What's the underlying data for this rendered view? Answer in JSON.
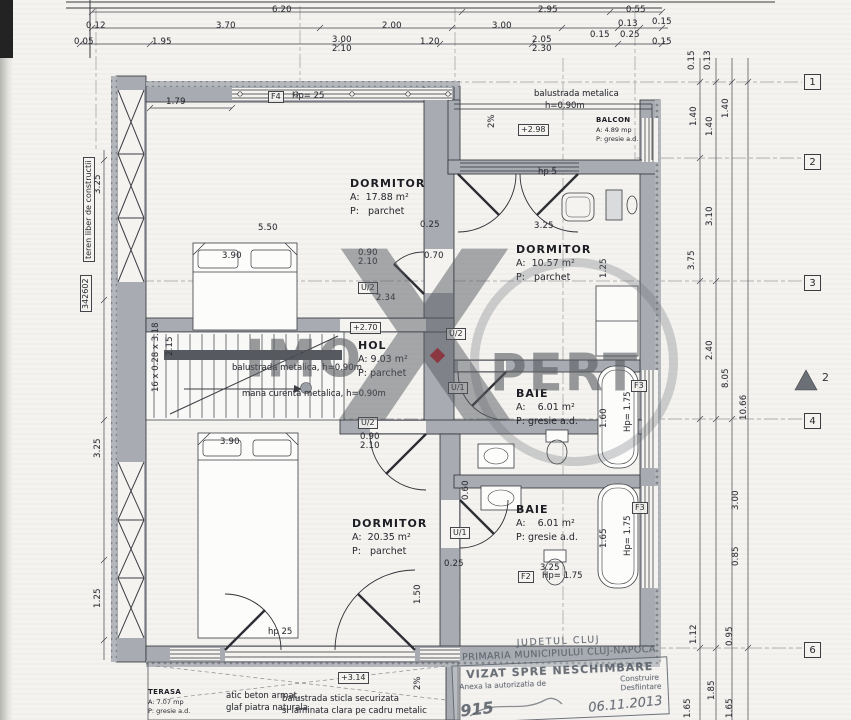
{
  "watermark": {
    "left": "IMO",
    "x_letter": "X",
    "right": "PERT"
  },
  "section_marker": {
    "label": "2"
  },
  "stamp": {
    "line1": "JUDETUL CLUJ",
    "line2": "PRIMARIA MUNICIPIULUI CLUJ-NAPOCA",
    "box_title": "VIZAT SPRE NESCHIMBARE",
    "box_sub": "Anexa la autorizatia de",
    "box_opt1": "Construire",
    "box_opt2": "Desfiintare",
    "hand1": "915",
    "hand2": "06.11.2013"
  },
  "rooms": [
    {
      "name": "DORMITOR",
      "area": "A:  17.88 m²",
      "floor": "P:   parchet",
      "x": 350,
      "y": 176
    },
    {
      "name": "DORMITOR",
      "area": "A:  10.57 m²",
      "floor": "P:   parchet",
      "x": 516,
      "y": 242
    },
    {
      "name": "HOL",
      "area": "A: 9.03 m²",
      "floor": "P: parchet",
      "x": 358,
      "y": 338
    },
    {
      "name": "BAIE",
      "area": "A:    6.01 m²",
      "floor": "P: gresie a.d.",
      "x": 516,
      "y": 386
    },
    {
      "name": "DORMITOR",
      "area": "A:  20.35 m²",
      "floor": "P:   parchet",
      "x": 352,
      "y": 516
    },
    {
      "name": "BAIE",
      "area": "A:    6.01 m²",
      "floor": "P: gresie a.d.",
      "x": 516,
      "y": 502
    },
    {
      "name": "BALCON",
      "area": "A: 4.89 mp",
      "floor": "P: gresie a.d.",
      "x": 596,
      "y": 116,
      "cls": "small"
    },
    {
      "name": "TERASA",
      "area": "A: 7.07 mp",
      "floor": "P: gresie a.d.",
      "x": 148,
      "y": 688,
      "cls": "small"
    }
  ],
  "dims": [
    {
      "t": "6.20",
      "x": 272,
      "y": 6
    },
    {
      "t": "2.95",
      "x": 538,
      "y": 6
    },
    {
      "t": "0.55",
      "x": 626,
      "y": 6
    },
    {
      "t": "0.12",
      "x": 86,
      "y": 22
    },
    {
      "t": "3.70",
      "x": 216,
      "y": 22
    },
    {
      "t": "2.00",
      "x": 382,
      "y": 22
    },
    {
      "t": "3.00",
      "x": 492,
      "y": 22
    },
    {
      "t": "0.13",
      "x": 618,
      "y": 20
    },
    {
      "t": "0.15",
      "x": 652,
      "y": 18
    },
    {
      "t": "0.15",
      "x": 590,
      "y": 31
    },
    {
      "t": "0.25",
      "x": 620,
      "y": 31
    },
    {
      "t": "0.05",
      "x": 74,
      "y": 38
    },
    {
      "t": "1.95",
      "x": 152,
      "y": 38
    },
    {
      "t": "3.00",
      "x": 332,
      "y": 36
    },
    {
      "t": "2.10",
      "x": 332,
      "y": 45
    },
    {
      "t": "1.20",
      "x": 420,
      "y": 38
    },
    {
      "t": "2.05",
      "x": 532,
      "y": 36
    },
    {
      "t": "2.30",
      "x": 532,
      "y": 45
    },
    {
      "t": "0.15",
      "x": 652,
      "y": 38
    },
    {
      "t": "1.79",
      "x": 166,
      "y": 98
    },
    {
      "t": "5.50",
      "x": 258,
      "y": 224
    },
    {
      "t": "3.90",
      "x": 222,
      "y": 252
    },
    {
      "t": "0.90",
      "x": 358,
      "y": 249
    },
    {
      "t": "2.10",
      "x": 358,
      "y": 258
    },
    {
      "t": "0.70",
      "x": 424,
      "y": 252
    },
    {
      "t": "0.25",
      "x": 420,
      "y": 221
    },
    {
      "t": "2.34",
      "x": 376,
      "y": 294
    },
    {
      "t": "3.25",
      "x": 534,
      "y": 222
    },
    {
      "t": "3.90",
      "x": 220,
      "y": 438
    },
    {
      "t": "0.90",
      "x": 360,
      "y": 433
    },
    {
      "t": "2.10",
      "x": 360,
      "y": 442
    },
    {
      "t": "0.25",
      "x": 444,
      "y": 560
    },
    {
      "t": "3.25",
      "x": 540,
      "y": 564
    },
    {
      "t": "1.50",
      "x": 414,
      "y": 604,
      "rot": 1
    },
    {
      "t": "0.60",
      "x": 462,
      "y": 500,
      "rot": 1
    },
    {
      "t": "1.60",
      "x": 600,
      "y": 428,
      "rot": 1
    },
    {
      "t": "1.65",
      "x": 600,
      "y": 548,
      "rot": 1
    },
    {
      "t": "1.25",
      "x": 600,
      "y": 278,
      "rot": 1
    },
    {
      "t": "2.15",
      "x": 166,
      "y": 356,
      "rot": 1
    },
    {
      "t": "0.15",
      "x": 688,
      "y": 70,
      "rot": 1
    },
    {
      "t": "0.13",
      "x": 704,
      "y": 70,
      "rot": 1
    },
    {
      "t": "1.40",
      "x": 690,
      "y": 126,
      "rot": 1
    },
    {
      "t": "1.40",
      "x": 706,
      "y": 136,
      "rot": 1
    },
    {
      "t": "1.40",
      "x": 722,
      "y": 118,
      "rot": 1
    },
    {
      "t": "3.10",
      "x": 706,
      "y": 226,
      "rot": 1
    },
    {
      "t": "3.75",
      "x": 688,
      "y": 270,
      "rot": 1
    },
    {
      "t": "2.40",
      "x": 706,
      "y": 360,
      "rot": 1
    },
    {
      "t": "8.05",
      "x": 722,
      "y": 388,
      "rot": 1
    },
    {
      "t": "10.66",
      "x": 740,
      "y": 420,
      "rot": 1
    },
    {
      "t": "3.00",
      "x": 732,
      "y": 510,
      "rot": 1
    },
    {
      "t": "0.85",
      "x": 732,
      "y": 566,
      "rot": 1
    },
    {
      "t": "1.12",
      "x": 690,
      "y": 644,
      "rot": 1
    },
    {
      "t": "0.95",
      "x": 726,
      "y": 646,
      "rot": 1
    },
    {
      "t": "1.85",
      "x": 708,
      "y": 700,
      "rot": 1
    },
    {
      "t": "1.65",
      "x": 684,
      "y": 718,
      "rot": 1
    },
    {
      "t": "1.65",
      "x": 726,
      "y": 718,
      "rot": 1
    },
    {
      "t": "3.25",
      "x": 94,
      "y": 194,
      "rot": 1
    },
    {
      "t": "3.25",
      "x": 94,
      "y": 458,
      "rot": 1
    },
    {
      "t": "1.25",
      "x": 94,
      "y": 608,
      "rot": 1
    }
  ],
  "texts": [
    {
      "t": "balustrada metalica",
      "x": 534,
      "y": 90
    },
    {
      "t": "h=0.90m",
      "x": 545,
      "y": 102
    },
    {
      "t": "2%",
      "x": 488,
      "y": 128,
      "rot": 1
    },
    {
      "t": "hp 5",
      "x": 538,
      "y": 168
    },
    {
      "t": "Hp= 25",
      "x": 292,
      "y": 92
    },
    {
      "t": "balustrada metalica, h=0.90m",
      "x": 232,
      "y": 364
    },
    {
      "t": "mana curenta metalica, h=0.90m",
      "x": 242,
      "y": 390
    },
    {
      "t": "16 x 0.28 x 3.18",
      "x": 152,
      "y": 392,
      "rot": 1
    },
    {
      "t": "hp 25",
      "x": 268,
      "y": 628
    },
    {
      "t": "Hp= 1.75",
      "x": 542,
      "y": 572
    },
    {
      "t": "Hp= 1.75",
      "x": 624,
      "y": 432,
      "rot": 1
    },
    {
      "t": "Hp= 1.75",
      "x": 624,
      "y": 556,
      "rot": 1
    },
    {
      "t": "atic beton armat,",
      "x": 226,
      "y": 692
    },
    {
      "t": "glaf piatra naturala",
      "x": 226,
      "y": 704
    },
    {
      "t": "balustrada sticla securizata",
      "x": 282,
      "y": 695
    },
    {
      "t": "si laminata clara pe cadru metalic",
      "x": 282,
      "y": 707
    },
    {
      "t": "2%",
      "x": 414,
      "y": 690,
      "rot": 1
    }
  ],
  "boxed": [
    {
      "t": "F4",
      "x": 268,
      "y": 91
    },
    {
      "t": "+2.98",
      "x": 518,
      "y": 124
    },
    {
      "t": "+2.70",
      "x": 350,
      "y": 322
    },
    {
      "t": "+3.14",
      "x": 338,
      "y": 672
    },
    {
      "t": "U/2",
      "x": 358,
      "y": 282
    },
    {
      "t": "U/2",
      "x": 446,
      "y": 328
    },
    {
      "t": "U/1",
      "x": 448,
      "y": 382
    },
    {
      "t": "U/2",
      "x": 358,
      "y": 417
    },
    {
      "t": "U/1",
      "x": 450,
      "y": 527
    },
    {
      "t": "F3",
      "x": 631,
      "y": 380
    },
    {
      "t": "F3",
      "x": 632,
      "y": 502
    },
    {
      "t": "F2",
      "x": 518,
      "y": 571
    },
    {
      "t": "teren liber de constructii",
      "x": 83,
      "y": 262,
      "rot": 1
    },
    {
      "t": "342602",
      "x": 80,
      "y": 312,
      "rot": 1
    }
  ],
  "grid_markers": [
    {
      "t": "1",
      "x": 804,
      "y": 74
    },
    {
      "t": "2",
      "x": 804,
      "y": 154
    },
    {
      "t": "3",
      "x": 804,
      "y": 275
    },
    {
      "t": "4",
      "x": 804,
      "y": 413
    },
    {
      "t": "6",
      "x": 804,
      "y": 642
    }
  ]
}
